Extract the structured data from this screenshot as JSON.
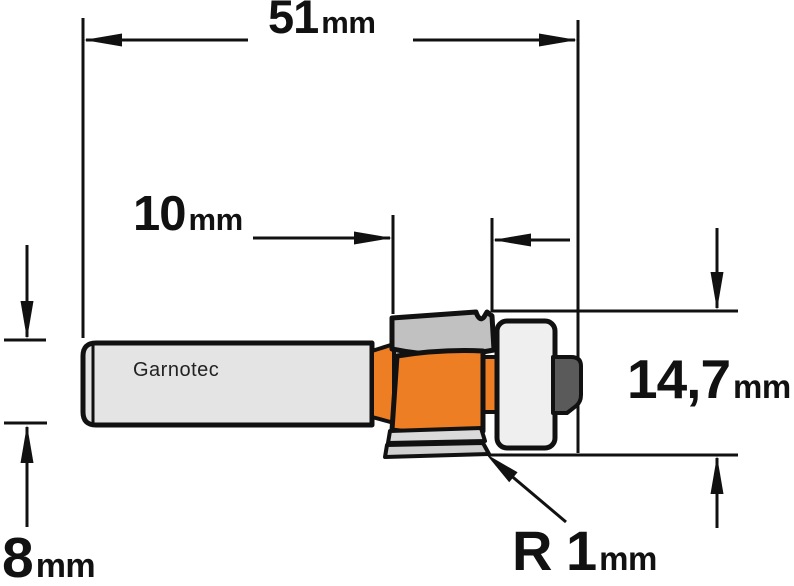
{
  "labels": {
    "overall_length": {
      "value": "51",
      "unit": "mm"
    },
    "cut_length": {
      "value": "10",
      "unit": "mm"
    },
    "cut_diameter": {
      "value": "14,7",
      "unit": "mm"
    },
    "shank_diameter": {
      "value": "8",
      "unit": "mm"
    },
    "corner_radius": {
      "value": "R 1",
      "unit": "mm"
    },
    "brand": "Garnotec"
  },
  "colors": {
    "cutter_orange": "#EE7E23",
    "shank_fill": "#E4E4E4",
    "wing_fill": "#C1C1C1",
    "slat_fill_1": "#DADADA",
    "slat_fill_2": "#D0D0D0",
    "bearing_fill": "#EFEFEF",
    "nut_fill": "#5A5A5A",
    "outline": "#111111",
    "background": "#FFFFFF"
  }
}
